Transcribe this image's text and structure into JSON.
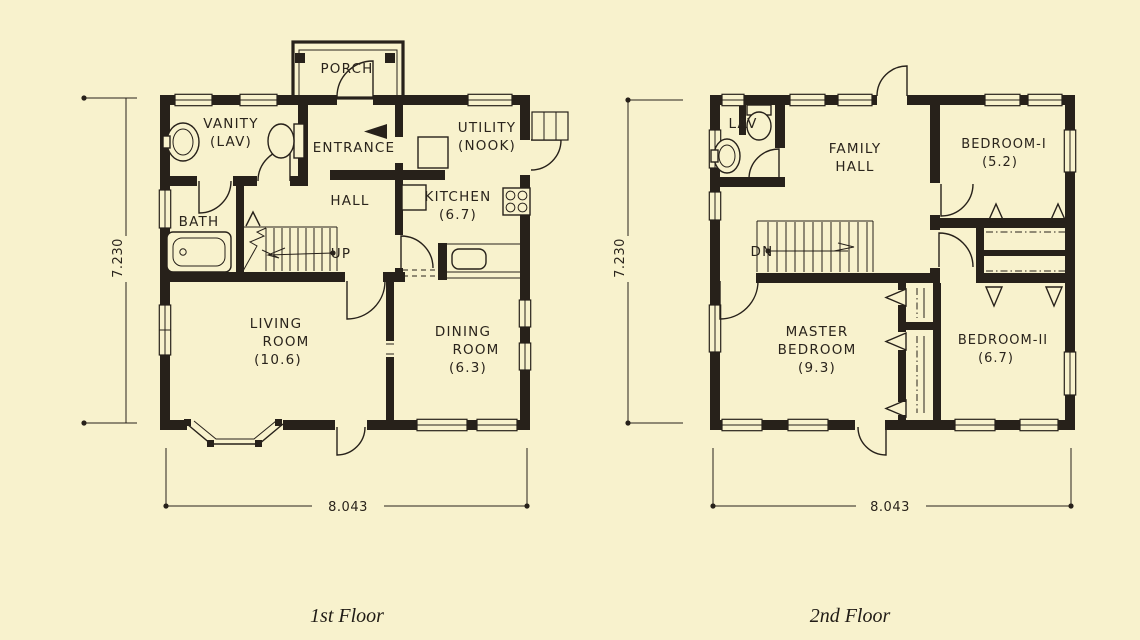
{
  "document": {
    "type": "scanned house floor plan drawing",
    "paper_color": "#f8f2cd",
    "ink_color": "#27211a"
  },
  "floors": [
    {
      "caption": "1st Floor",
      "dims": {
        "height": "7.230",
        "width": "8.043"
      },
      "rooms": {
        "porch": "PORCH",
        "vanity_1": "VANITY",
        "vanity_2": "(LAV)",
        "entrance": "ENTRANCE",
        "utility_1": "UTILITY",
        "utility_2": "(NOOK)",
        "hall": "HALL",
        "kitchen_1": "KITCHEN",
        "kitchen_2": "(6.7)",
        "bath": "BATH",
        "stair": "UP",
        "living_1": "LIVING",
        "living_2": "ROOM",
        "living_3": "(10.6)",
        "dining_1": "DINING",
        "dining_2": "ROOM",
        "dining_3": "(6.3)"
      }
    },
    {
      "caption": "2nd Floor",
      "dims": {
        "height": "7.230",
        "width": "8.043"
      },
      "rooms": {
        "lav": "LAV",
        "family_1": "FAMILY",
        "family_2": "HALL",
        "bedroom1_1": "BEDROOM-I",
        "bedroom1_2": "(5.2)",
        "stair": "DN",
        "master_1": "MASTER",
        "master_2": "BEDROOM",
        "master_3": "(9.3)",
        "bedroom2_1": "BEDROOM-II",
        "bedroom2_2": "(6.7)"
      }
    }
  ]
}
